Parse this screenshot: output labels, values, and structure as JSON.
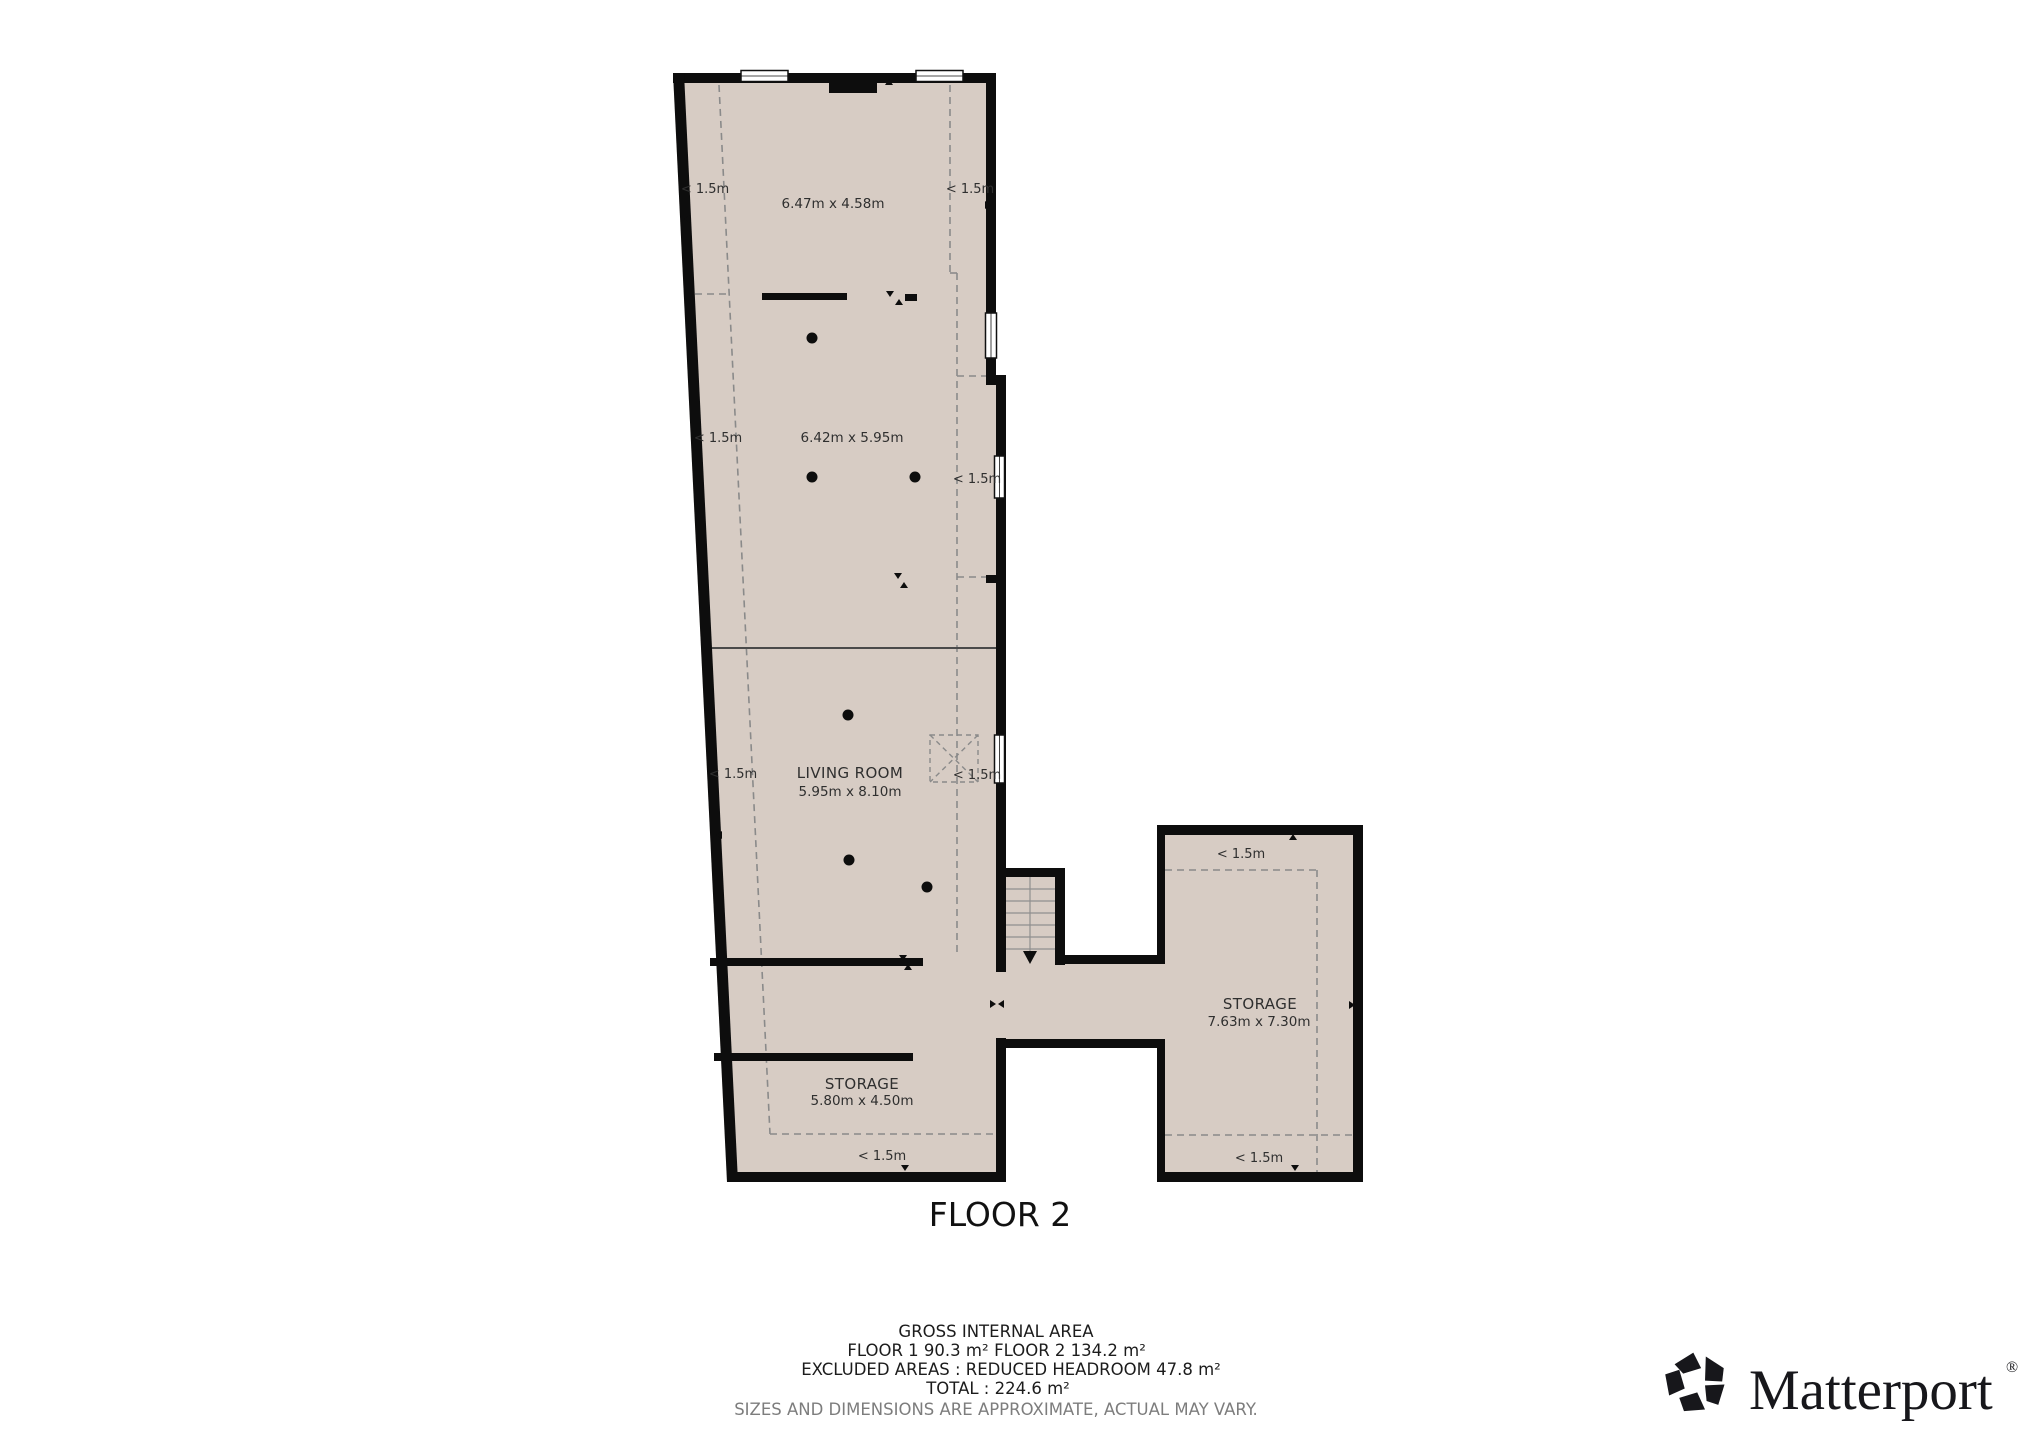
{
  "floor_plan": {
    "title": "FLOOR 2",
    "rooms": [
      {
        "label": "",
        "dims": "6.47m x 4.58m"
      },
      {
        "label": "",
        "dims": "6.42m x 5.95m"
      },
      {
        "label": "LIVING ROOM",
        "dims": "5.95m x 8.10m"
      },
      {
        "label": "STORAGE",
        "dims": "7.63m x 7.30m"
      },
      {
        "label": "STORAGE",
        "dims": "5.80m x 4.50m"
      }
    ],
    "labels": {
      "headroom": "< 1.5m"
    }
  },
  "footer": {
    "gross": "GROSS INTERNAL AREA",
    "floor1": "FLOOR 1 90.3 m²",
    "floor2": "FLOOR 2 134.2 m²",
    "excluded": "EXCLUDED AREAS :  REDUCED HEADROOM 47.8 m²",
    "total": "TOTAL :  224.6 m²",
    "disclaimer": "SIZES AND DIMENSIONS ARE APPROXIMATE, ACTUAL MAY VARY."
  },
  "brand": {
    "name": "Matterport",
    "registered": "®"
  },
  "colors": {
    "floor_fill": "#d7ccc4",
    "wall": "#0d0d0d",
    "dashed_line": "#8a8a8a",
    "text": "#2f2f2f"
  }
}
